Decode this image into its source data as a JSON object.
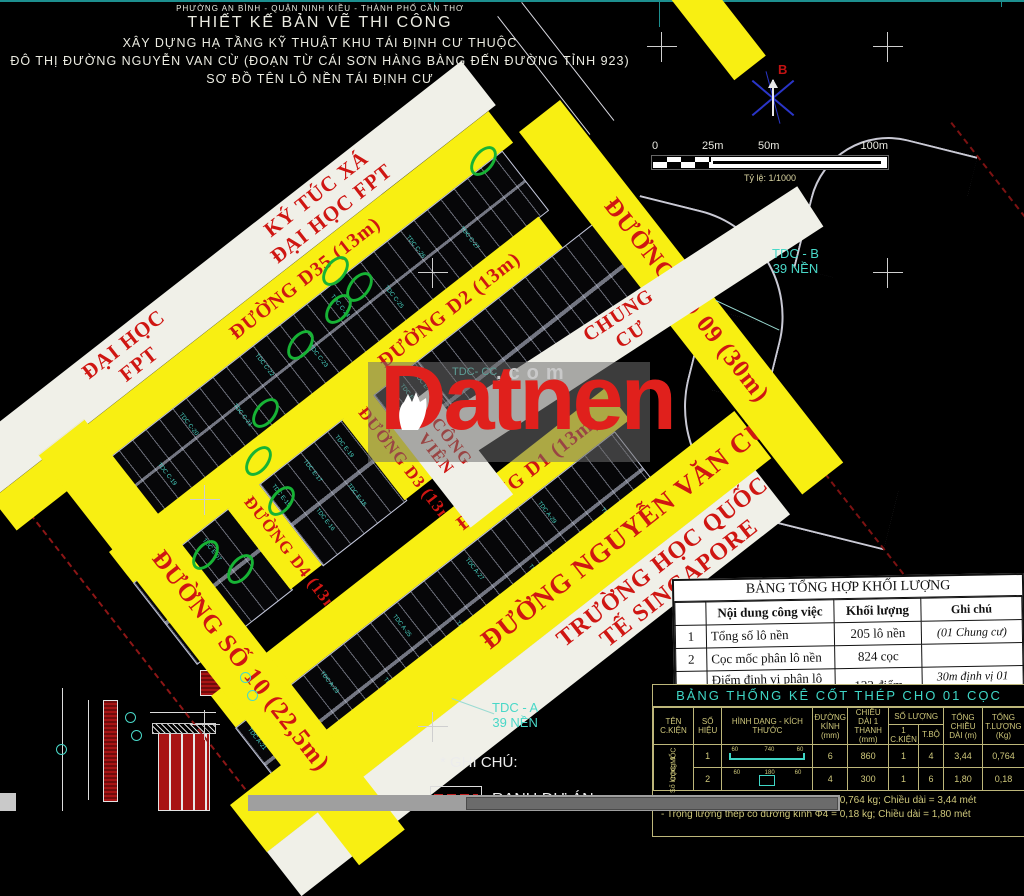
{
  "header": {
    "line1": "PHƯỜNG AN BÌNH - QUẬN NINH KIỀU - THÀNH PHỐ CẦN THƠ",
    "line2": "THIẾT KẾ BẢN VẼ THI CÔNG",
    "line3": "XÂY DỰNG HẠ TẦNG KỸ THUẬT KHU TÁI ĐỊNH CƯ THUỘC",
    "line4": "ĐÔ THỊ ĐƯỜNG NGUYỄN VAN CỪ (ĐOẠN TỪ CÁI SƠN HÀNG BÀNG ĐẾN ĐƯỜNG TỈNH 923)",
    "line5": "SƠ ĐỒ TÊN LÔ NỀN TÁI ĐỊNH CƯ"
  },
  "compass": {
    "north_label": "B"
  },
  "scalebar": {
    "ticks": [
      "0",
      "25m",
      "50m",
      "100m"
    ],
    "caption": "Tỷ lệ: 1/1000"
  },
  "watermark": {
    "brand": "Datnen",
    "suffix": ".com"
  },
  "roads": {
    "d35": "ĐƯỜNG D35 (13m)",
    "d2": "ĐƯỜNG D2 (13m)",
    "d3": "ĐƯỜNG D3 (13m)",
    "d4": "ĐƯỜNG D4 (13m)",
    "d1": "ĐƯỜNG D1 (13m)",
    "so09": "ĐƯỜNG SỐ 09 (30m)",
    "so10": "ĐƯỜNG SỐ 10 (22,5m)",
    "nvc": "ĐƯỜNG NGUYỄN VĂN CỪ"
  },
  "zones": {
    "ktx_line1": "KÝ TÚC XÁ",
    "ktx_line2": "ĐẠI HỌC FPT",
    "fpt_line1": "ĐẠI HỌC",
    "fpt_line2": "FPT",
    "chung_cu_1": "CHUNG",
    "chung_cu_2": "CƯ",
    "cong_vien_1": "CÔNG",
    "cong_vien_2": "VIÊN",
    "sgp_line1": "TRƯỜNG HỌC QUỐC",
    "sgp_line2": "TẾ SINGAPORE",
    "tdc_cc": "TDC- CC"
  },
  "annotations": {
    "tdc_b1": "TDC - B",
    "tdc_b2": "39 NỀN",
    "tdc_a1": "TDC - A",
    "tdc_a2": "39 NỀN",
    "ghi_chu": "* GHI CHÚ:",
    "ranh_du_an": "RANH DỰ ÁN"
  },
  "plot_labels": {
    "block_c": [
      "TDC C-18",
      "TDC C-19",
      "TDC C-20",
      "TDC C-21",
      "TDC C-22",
      "TDC C-23",
      "TDC C-24",
      "TDC C-25",
      "TDC C-26",
      "TDC C-27"
    ],
    "block_m1": [
      "TDC E-05",
      "TDC E-06",
      "TDC E-07"
    ],
    "block_m2": [
      "TDC E-15",
      "TDC E-16",
      "TDC E-17",
      "TDC E-18",
      "TDC E-19"
    ],
    "block_m3": [
      "TDC E-25",
      "TDC E-26",
      "TDC E-27",
      "TDC E-28",
      "TDC E-29",
      "TDC E-30"
    ],
    "block_a": [
      "TDC A-21",
      "TDC A-22",
      "TDC A-23",
      "TDC A-24",
      "TDC A-25",
      "TDC A-26",
      "TDC A-27",
      "TDC A-28",
      "TDC A-29",
      "TDC A-30"
    ]
  },
  "table1": {
    "title": "BẢNG TỔNG HỢP KHỐI LƯỢNG",
    "headers": [
      "",
      "Nội dung công việc",
      "Khối lượng",
      "Ghi chú"
    ],
    "rows": [
      [
        "1",
        "Tổng số lô nền",
        "205 lô nền",
        "(01 Chung cư)"
      ],
      [
        "2",
        "Cọc mốc phân lô nền",
        "824 cọc",
        ""
      ],
      [
        "3",
        "Điểm định vị phân lô nền",
        "122 điểm",
        "30m định vị 01 điểm"
      ]
    ]
  },
  "table2": {
    "title": "BẢNG THỐNG KÊ CỐT THÉP CHO 01 CỌC",
    "headers": {
      "ten_ckien": "TÊN C.KIỆN",
      "so_hieu": "SỐ HIỆU",
      "hinh_dang": "HÌNH DẠNG - KÍCH THƯỚC",
      "duong_kinh": "ĐƯỜNG KÍNH (mm)",
      "chieu_dai": "CHIỀU DÀI 1 THANH (mm)",
      "so_luong": "SỐ LƯỢNG",
      "sl_1ckien": "1 C.KIỆN",
      "sl_tbo": "T.BỘ",
      "tong_cd": "TỔNG CHIỀU DÀI (m)",
      "tong_tl": "TỔNG T.LƯỢNG (Kg)"
    },
    "side_label1": "CỌC MỐC",
    "side_label2": "Số lượng: 1",
    "rows": [
      {
        "so_hieu": "1",
        "shape": "bar",
        "dims": [
          "60",
          "740",
          "60"
        ],
        "duong_kinh": "6",
        "chieu_dai": "860",
        "sl_1ckien": "1",
        "sl_tbo": "4",
        "tong_cd": "3,44",
        "tong_tl": "0,764"
      },
      {
        "so_hieu": "2",
        "shape": "rect",
        "dims": [
          "60",
          "180",
          "60"
        ],
        "duong_kinh": "4",
        "chieu_dai": "300",
        "sl_1ckien": "1",
        "sl_tbo": "6",
        "tong_cd": "1,80",
        "tong_tl": "0,18"
      }
    ],
    "notes": [
      "- Trọng lượng thép có đường kính Φ6  =  0,764 kg; Chiều dài = 3,44 mét",
      "- Trọng lượng thép có đường kính Φ4  =  0,18 kg; Chiều dài = 1,80 mét"
    ]
  },
  "colors": {
    "road_yellow": "#f8ef12",
    "label_red": "#cf1612",
    "plot_teal": "#49d8c8",
    "table_khaki": "#cfc87b",
    "circle_green": "#17b335"
  }
}
